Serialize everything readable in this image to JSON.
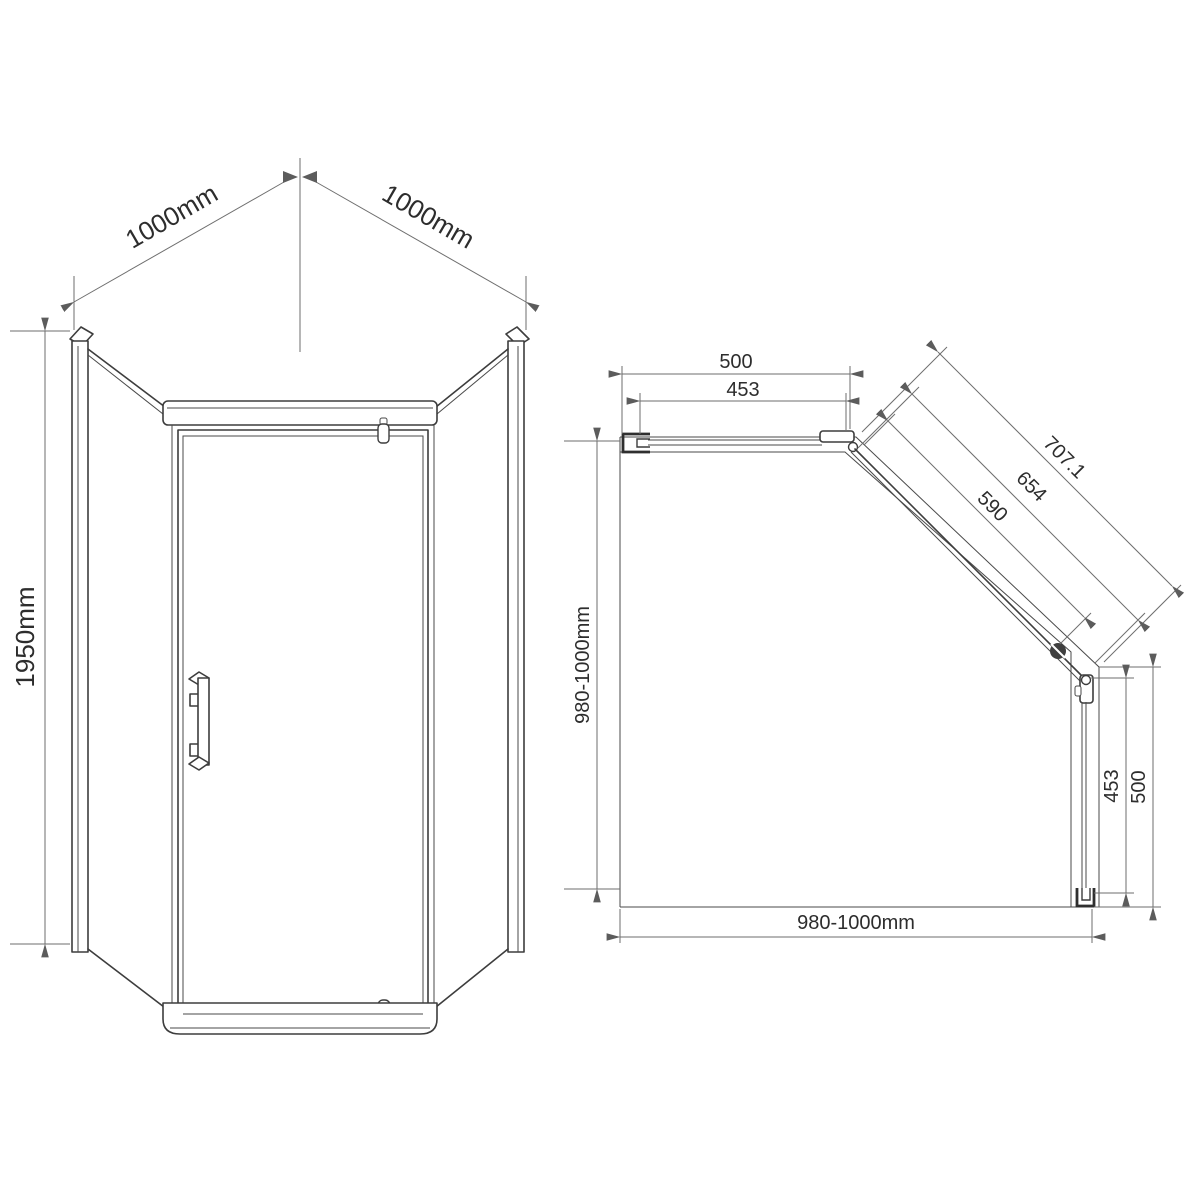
{
  "drawing_title": "pentagonal-shower-enclosure-technical-drawing",
  "front_view": {
    "top_left_width": "1000mm",
    "top_right_width": "1000mm",
    "height": "1950mm"
  },
  "plan_view": {
    "top_width_outer": "500",
    "top_width_inner": "453",
    "diagonal_outer": "707.1",
    "diagonal_middle": "654",
    "diagonal_inner": "590",
    "depth_left": "980-1000mm",
    "width_bottom": "980-1000mm",
    "right_depth_inner": "453",
    "right_depth_outer": "500"
  },
  "colors": {
    "background": "#ffffff",
    "structure_line": "#3d3d3d",
    "dimension_line": "#6e6e6e",
    "text": "#2d2d2d"
  }
}
